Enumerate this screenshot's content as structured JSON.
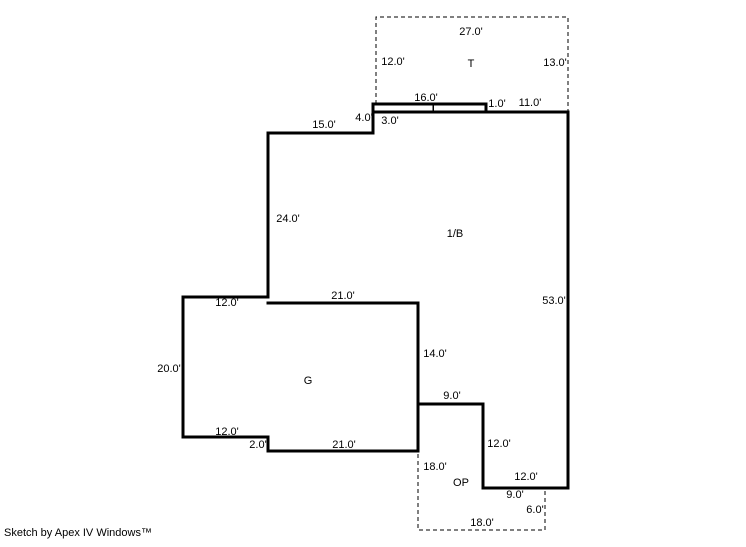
{
  "footer": {
    "credit": "Sketch by Apex IV Windows™"
  },
  "sketch": {
    "canvas": {
      "width": 746,
      "height": 547
    },
    "colors": {
      "line": "#000000",
      "background": "#ffffff"
    },
    "style": {
      "wall_stroke_width": 3,
      "dash_stroke_width": 1,
      "dash_pattern": "4,3",
      "label_font_size": 11
    },
    "areas": [
      {
        "code": "T",
        "x": 471,
        "y": 64
      },
      {
        "code": "1/B",
        "x": 455,
        "y": 234
      },
      {
        "code": "G",
        "x": 308,
        "y": 381
      },
      {
        "code": "OP",
        "x": 461,
        "y": 483
      }
    ],
    "solid_walls": [
      {
        "name": "main-outline",
        "closed": true,
        "points": [
          [
            373,
            104
          ],
          [
            486,
            104
          ],
          [
            486,
            112
          ],
          [
            568,
            112
          ],
          [
            568,
            488
          ],
          [
            483,
            488
          ],
          [
            483,
            404
          ],
          [
            418,
            404
          ],
          [
            418,
            451
          ],
          [
            268,
            451
          ],
          [
            268,
            437
          ],
          [
            183,
            437
          ],
          [
            183,
            297
          ],
          [
            268,
            297
          ],
          [
            268,
            133
          ],
          [
            373,
            133
          ]
        ]
      },
      {
        "name": "garage-division-wall",
        "closed": false,
        "points": [
          [
            268,
            303
          ],
          [
            418,
            303
          ],
          [
            418,
            451
          ]
        ]
      },
      {
        "name": "wall-under-stoop",
        "closed": false,
        "points": [
          [
            373,
            112
          ],
          [
            486,
            112
          ]
        ]
      },
      {
        "name": "stoop-tick",
        "closed": false,
        "stroke_width": 1.5,
        "points": [
          [
            433,
            104
          ],
          [
            433,
            112
          ]
        ]
      }
    ],
    "dashed_outlines": [
      {
        "name": "t-area-outline",
        "points": [
          [
            376,
            104
          ],
          [
            376,
            17
          ],
          [
            568,
            17
          ],
          [
            568,
            111
          ]
        ]
      },
      {
        "name": "op-area-outline",
        "points": [
          [
            418,
            454
          ],
          [
            418,
            530
          ],
          [
            545,
            530
          ],
          [
            545,
            489
          ]
        ]
      }
    ],
    "dimension_labels": [
      {
        "text": "27.0'",
        "x": 471,
        "y": 32
      },
      {
        "text": "12.0'",
        "x": 393,
        "y": 62
      },
      {
        "text": "13.0'",
        "x": 555,
        "y": 63
      },
      {
        "text": "16.0'",
        "x": 426,
        "y": 98
      },
      {
        "text": "1.0'",
        "x": 497,
        "y": 104
      },
      {
        "text": "11.0'",
        "x": 530,
        "y": 103
      },
      {
        "text": "4.0'",
        "x": 364,
        "y": 118
      },
      {
        "text": "3.0'",
        "x": 390,
        "y": 121
      },
      {
        "text": "15.0'",
        "x": 324,
        "y": 125
      },
      {
        "text": "24.0'",
        "x": 288,
        "y": 219
      },
      {
        "text": "53.0'",
        "x": 554,
        "y": 301
      },
      {
        "text": "21.0'",
        "x": 343,
        "y": 296
      },
      {
        "text": "12.0'",
        "x": 227,
        "y": 303
      },
      {
        "text": "14.0'",
        "x": 435,
        "y": 354
      },
      {
        "text": "20.0'",
        "x": 169,
        "y": 369
      },
      {
        "text": "9.0'",
        "x": 452,
        "y": 396
      },
      {
        "text": "12.0'",
        "x": 227,
        "y": 432
      },
      {
        "text": "2.0'",
        "x": 258,
        "y": 445
      },
      {
        "text": "21.0'",
        "x": 344,
        "y": 445
      },
      {
        "text": "12.0'",
        "x": 499,
        "y": 444
      },
      {
        "text": "18.0'",
        "x": 435,
        "y": 467
      },
      {
        "text": "12.0'",
        "x": 526,
        "y": 477
      },
      {
        "text": "9.0'",
        "x": 515,
        "y": 495
      },
      {
        "text": "6.0'",
        "x": 535,
        "y": 510
      },
      {
        "text": "18.0'",
        "x": 482,
        "y": 523
      }
    ]
  }
}
